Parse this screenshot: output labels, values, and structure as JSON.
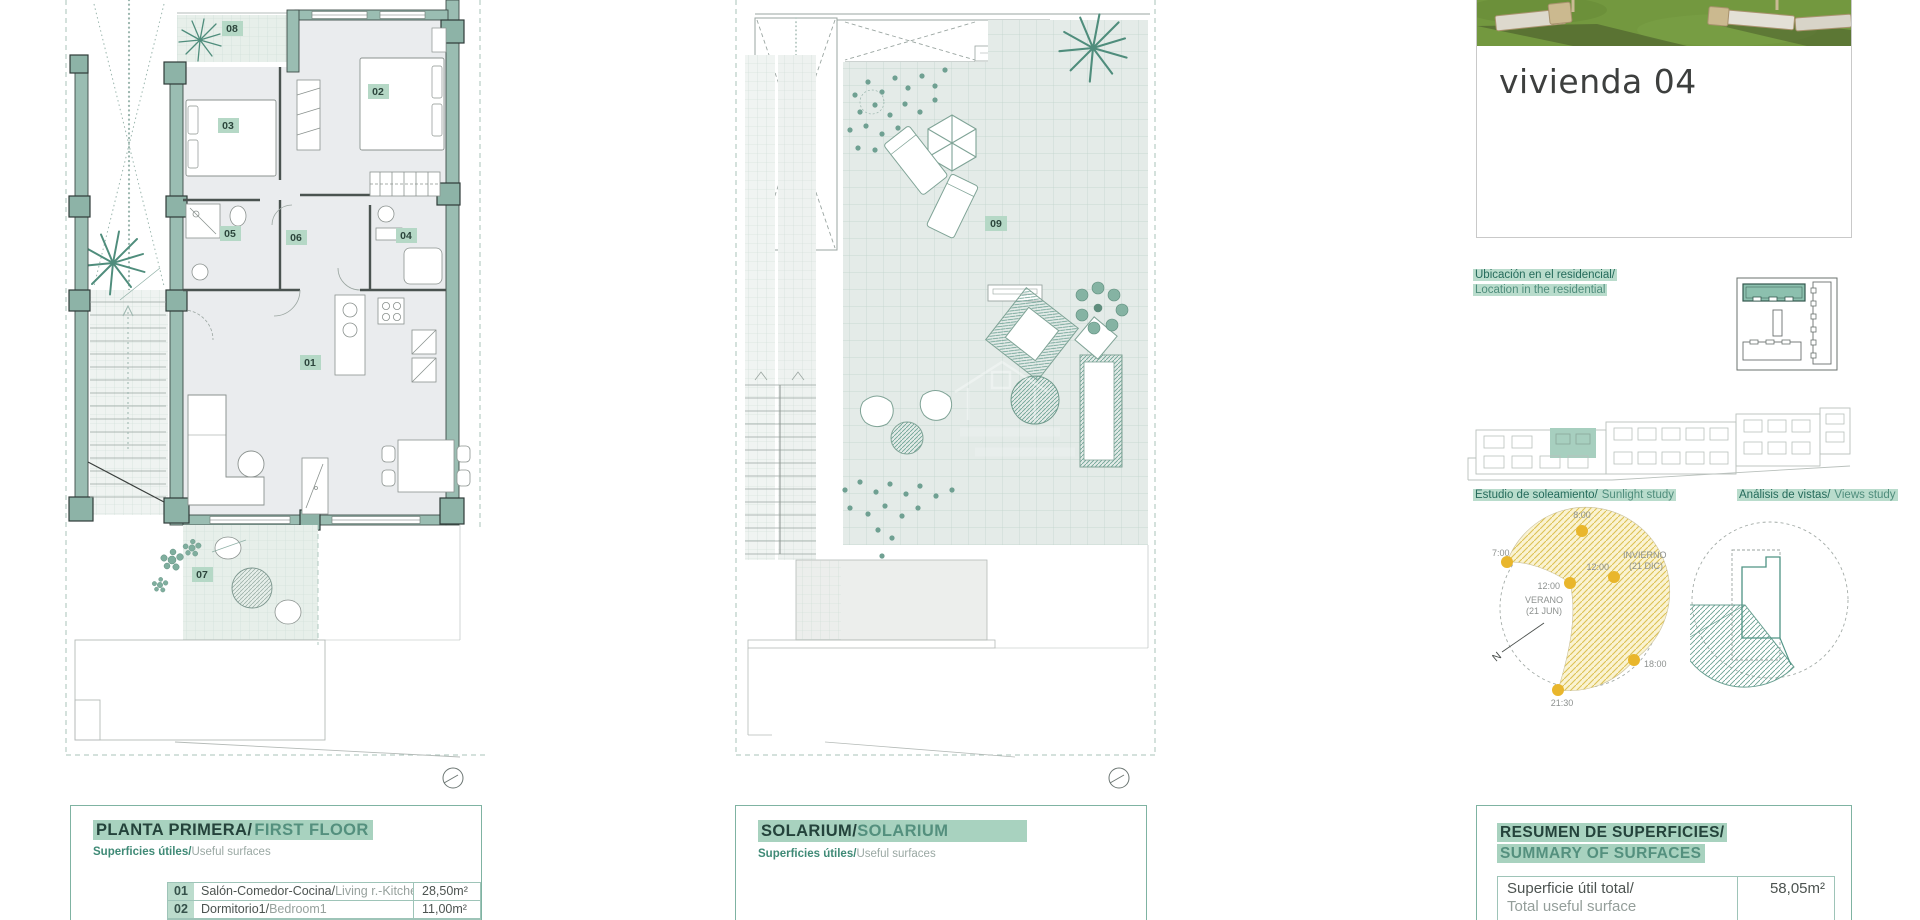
{
  "plan_first_floor": {
    "room_labels": {
      "r01": "01",
      "r02": "02",
      "r03": "03",
      "r04": "04",
      "r05": "05",
      "r06": "06",
      "r07": "07",
      "r08": "08"
    }
  },
  "plan_solarium": {
    "room_labels": {
      "r09": "09"
    }
  },
  "panel_first_floor": {
    "title_es": "PLANTA PRIMERA/",
    "title_en": "FIRST FLOOR",
    "subtitle_es": "Superficies útiles/",
    "subtitle_en": "Useful surfaces",
    "rows": [
      {
        "num": "01",
        "name_es": "Salón-Comedor-Cocina/",
        "name_en": "Living r.-Kitchen",
        "area": "28,50m²"
      },
      {
        "num": "02",
        "name_es": "Dormitorio1/",
        "name_en": "Bedroom1",
        "area": "11,00m²"
      }
    ]
  },
  "panel_solarium": {
    "title_es": "SOLARIUM/",
    "title_en": "SOLARIUM",
    "subtitle_es": "Superficies útiles/",
    "subtitle_en": "Useful surfaces"
  },
  "sidebar": {
    "card_title": "vivienda 04",
    "location_es": "Ubicación en el residencial/",
    "location_en": "Location in the residential",
    "sunlight_es": "Estudio de soleamiento/",
    "sunlight_en": "Sunlight study",
    "views_es": "Análisis de vistas/",
    "views_en": "Views study",
    "sun_diagram": {
      "time_8": "8:00",
      "time_7": "7:00",
      "time_12_summer": "12:00",
      "time_12_winter": "12:00",
      "time_18": "18:00",
      "time_2130": "21:30",
      "summer_label": "VERANO",
      "summer_date": "(21 JUN)",
      "winter_label": "INVIERNO",
      "winter_date": "(21 DIC)",
      "north": "N"
    },
    "summary": {
      "title_es": "RESUMEN DE SUPERFICIES/",
      "title_en": "SUMMARY OF SURFACES",
      "rows": [
        {
          "label_es": "Superficie útil total/",
          "label_en": "Total useful surface",
          "value": "58,05m²"
        }
      ]
    }
  },
  "colors": {
    "wall_teal": "#9abdb2",
    "accent_dark": "#24433b",
    "accent": "#3f8a76",
    "accent_light": "#54907e",
    "highlight": "#a8d2bf",
    "chip_bg": "#b5d8c6",
    "sun_yellow": "#e9b62c",
    "views_teal": "#5f9b8c",
    "grass_green": "#73983f"
  }
}
